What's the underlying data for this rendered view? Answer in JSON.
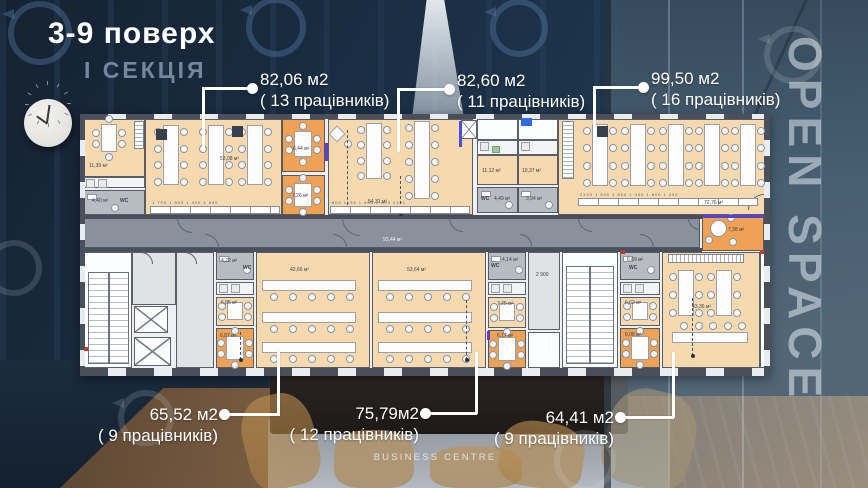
{
  "header": {
    "title": "3-9 поверх",
    "section": "І СЕКЦІЯ"
  },
  "watermarks": {
    "glass_text": "OPEN SPACE",
    "footer": "BUSINESS CENTRE",
    "ring_icon": "circular-arrow-watermark"
  },
  "callouts": {
    "top": [
      {
        "area": "82,06 м2",
        "workers": "( 13 працівників)"
      },
      {
        "area": "82,60 м2",
        "workers": "( 11 працівників)"
      },
      {
        "area": "99,50 м2",
        "workers": "( 16 працівників)"
      }
    ],
    "bottom": [
      {
        "area": "65,52 м2",
        "workers": "( 9 працівників)"
      },
      {
        "area": "75,79м2",
        "workers": "( 12 працівників)"
      },
      {
        "area": "64,41 м2",
        "workers": "( 9 працівників)"
      }
    ]
  },
  "plan": {
    "rooms": [
      {
        "id": "r1139",
        "label": "11,39 м²"
      },
      {
        "id": "r440",
        "label": "4,40 м²",
        "tag": "WC"
      },
      {
        "id": "os1",
        "label": "53,08 м²"
      },
      {
        "id": "m644",
        "label": "6,44 м²"
      },
      {
        "id": "m726",
        "label": "7,26 м²"
      },
      {
        "id": "os2",
        "label": "54,31 м²"
      },
      {
        "id": "r1112",
        "label": "11,12 м²"
      },
      {
        "id": "r449",
        "label": "4,49 м²",
        "tag": "WC"
      },
      {
        "id": "r1037",
        "label": "10,37 м²"
      },
      {
        "id": "r394",
        "label": "3,94 м²"
      },
      {
        "id": "os3",
        "label": "72,76 м²"
      },
      {
        "id": "mC",
        "label": "7,38 м²"
      },
      {
        "id": "corr",
        "label": "93,44 м²",
        "light": true
      },
      {
        "id": "r422",
        "label": "4,22 м²",
        "tag": "WC"
      },
      {
        "id": "r685",
        "label": "6,85 м²"
      },
      {
        "id": "r687",
        "label": "6,87 м²"
      },
      {
        "id": "b1",
        "label": "42,66 м²"
      },
      {
        "id": "b2",
        "label": "53,64 м²"
      },
      {
        "id": "r414",
        "label": "4,14 м²",
        "tag": "WC"
      },
      {
        "id": "r725",
        "label": "7,25 м²"
      },
      {
        "id": "r617",
        "label": "6,17 м²"
      },
      {
        "id": "g29",
        "label": "2 900"
      },
      {
        "id": "r609",
        "label": "6,09 м²",
        "tag": "WC"
      },
      {
        "id": "r662",
        "label": "6,62 м²"
      },
      {
        "id": "r608",
        "label": "6,08 м²"
      },
      {
        "id": "b3",
        "label": "43,36 м²"
      }
    ],
    "dimension_rows": [
      {
        "id": "os1",
        "text": "1 795  1 800  1 400  1 600"
      },
      {
        "id": "os2",
        "text": "800  1635  1 600  1 600  2150"
      },
      {
        "id": "os3",
        "text": "2100  1 500  1 800  1 400  1 800  1 400"
      }
    ],
    "colors": {
      "open_space": "#f6d9ae",
      "meeting_room": "#efa155",
      "wc": "#b7bcc3",
      "lobby": "#e1e2e4",
      "white_room": "#fbfcfd",
      "kitchen": "#f3f4f6",
      "corridor": "#8b919a",
      "wall": "#49505c",
      "accent_blue": "#4a4fd6",
      "accent_purple": "#5b3fd0",
      "leader": "#ffffff"
    }
  }
}
